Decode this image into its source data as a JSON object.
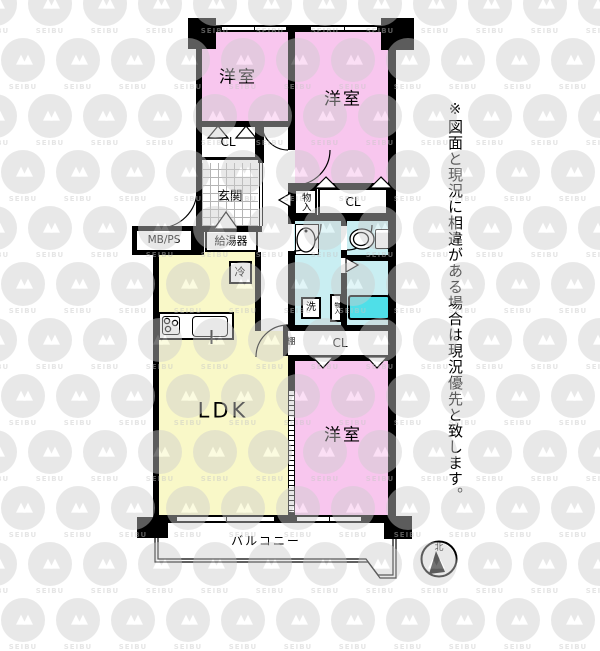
{
  "plan": {
    "rooms": [
      {
        "id": "bedroom-top-left",
        "label": "洋室"
      },
      {
        "id": "bedroom-top-right",
        "label": "洋室"
      },
      {
        "id": "bedroom-bottom",
        "label": "洋室"
      },
      {
        "id": "ldk",
        "label": "LDK"
      },
      {
        "id": "balcony",
        "label": "バルコニー"
      }
    ],
    "closets": {
      "cl1": "CL",
      "cl2": "CL",
      "cl3": "CL",
      "monoire": "物入",
      "tana": "棚",
      "small_store": "物入"
    },
    "labels": {
      "genkan": "玄関",
      "mbps": "MB/PS",
      "water_heater": "給湯器",
      "fridge": "冷",
      "washer": "洗"
    }
  },
  "compass": {
    "north": "北"
  },
  "disclaimer": "※図面と現況に相違がある場合は現況優先と致します。",
  "watermark": {
    "brand": "SEIBU"
  },
  "colors": {
    "bedroom": "#f8c6ee",
    "ldk": "#f9f8c8",
    "wet_area": "#c9eef2",
    "bathtub": "#4fdfe8",
    "wall": "#000000"
  }
}
